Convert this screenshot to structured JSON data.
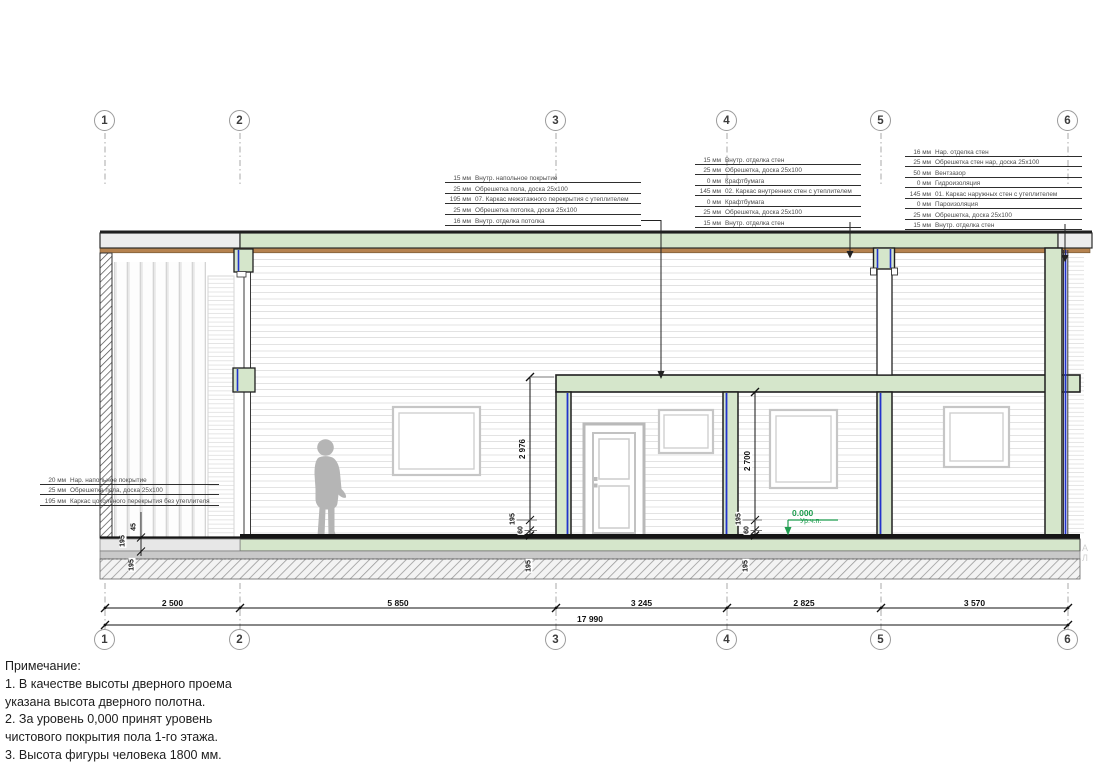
{
  "drawing": {
    "grid_labels": [
      "1",
      "2",
      "3",
      "4",
      "5",
      "6"
    ],
    "dims_bottom": {
      "segments": [
        "2 500",
        "5 850",
        "3 245",
        "2 825",
        "3 570"
      ],
      "total": "17 990"
    },
    "dims_vertical": {
      "left_room_height": "2 976",
      "right_room_height": "2 700"
    },
    "dims_small": {
      "mid_195": "195",
      "mid_60": "60",
      "mid_found_195": "195",
      "right_195": "195",
      "right_60": "60",
      "right_found_195": "195",
      "porch_45": "45",
      "porch_195": "195",
      "porch_found_195": "195"
    },
    "level_mark": {
      "value": "0.000",
      "label": "Ур.ч.п."
    },
    "watermark": "АЛ",
    "colors": {
      "cut_wall_green": "#d5e6cb",
      "membrane_blue": "#2233cc",
      "level_green": "#1f9d4f",
      "wood_line_brown": "#b5824f"
    }
  },
  "callouts": {
    "floor_interstorey": {
      "rows": [
        [
          "15 мм",
          "Внутр. напольное покрытие"
        ],
        [
          "25 мм",
          "Обрешетка пола, доска 25x100"
        ],
        [
          "195 мм",
          "07. Каркас межэтажного перекрытия с утеплителем"
        ],
        [
          "25 мм",
          "Обрешетка потолка, доска 25x100"
        ],
        [
          "16 мм",
          "Внутр. отделка потолка"
        ]
      ]
    },
    "walls_internal": {
      "rows": [
        [
          "15 мм",
          "Внутр. отделка стен"
        ],
        [
          "25 мм",
          "Обрешетка, доска 25x100"
        ],
        [
          "0 мм",
          "Крафтбумага"
        ],
        [
          "145 мм",
          "02. Каркас внутренних стен с утеплителем"
        ],
        [
          "0 мм",
          "Крафтбумага"
        ],
        [
          "25 мм",
          "Обрешетка, доска 25x100"
        ],
        [
          "15 мм",
          "Внутр. отделка стен"
        ]
      ]
    },
    "walls_external": {
      "rows": [
        [
          "16 мм",
          "Нар. отделка стен"
        ],
        [
          "25 мм",
          "Обрешетка стен нар, доска 25x100"
        ],
        [
          "50 мм",
          "Вентзазор"
        ],
        [
          "0 мм",
          "Гидроизоляция"
        ],
        [
          "145 мм",
          "01. Каркас наружных стен с утеплителем"
        ],
        [
          "0 мм",
          "Пароизоляция"
        ],
        [
          "25 мм",
          "Обрешетка, доска 25x100"
        ],
        [
          "15 мм",
          "Внутр. отделка стен"
        ]
      ]
    },
    "floor_ground": {
      "rows": [
        [
          "20 мм",
          "Нар. напольное покрытие"
        ],
        [
          "25 мм",
          "Обрешетка пола, доска 25x100"
        ],
        [
          "195 мм",
          "Каркас цокольного перекрытия без утеплителя"
        ]
      ]
    }
  },
  "notes": {
    "title": "Примечание:",
    "lines": [
      "1. В качестве высоты дверного проема",
      "указана высота дверного полотна.",
      "2. За уровень 0,000 принят уровень",
      "чистового покрытия пола 1-го этажа.",
      "3. Высота фигуры человека 1800 мм."
    ]
  }
}
